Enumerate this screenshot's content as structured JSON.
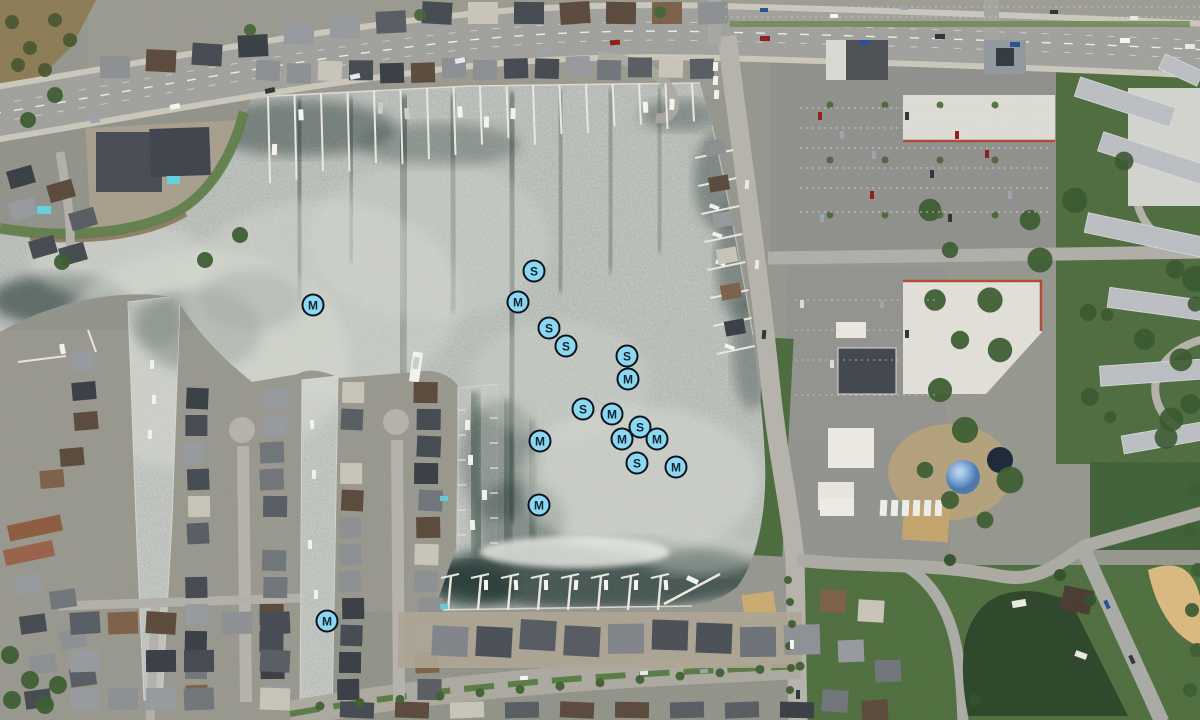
{
  "map": {
    "view": "satellite",
    "marker_style": {
      "fill": "#8ED7F0",
      "border": "#0C1420",
      "label_color": "#0C2433",
      "diameter_px": 23
    },
    "markers": [
      {
        "label": "M",
        "x": 313,
        "y": 305
      },
      {
        "label": "S",
        "x": 534,
        "y": 271
      },
      {
        "label": "M",
        "x": 518,
        "y": 302
      },
      {
        "label": "S",
        "x": 549,
        "y": 328
      },
      {
        "label": "S",
        "x": 566,
        "y": 346
      },
      {
        "label": "S",
        "x": 627,
        "y": 356
      },
      {
        "label": "M",
        "x": 628,
        "y": 379
      },
      {
        "label": "S",
        "x": 583,
        "y": 409
      },
      {
        "label": "M",
        "x": 612,
        "y": 414
      },
      {
        "label": "S",
        "x": 640,
        "y": 427
      },
      {
        "label": "M",
        "x": 622,
        "y": 439
      },
      {
        "label": "M",
        "x": 540,
        "y": 441
      },
      {
        "label": "M",
        "x": 657,
        "y": 439
      },
      {
        "label": "S",
        "x": 637,
        "y": 463
      },
      {
        "label": "M",
        "x": 676,
        "y": 467
      },
      {
        "label": "M",
        "x": 539,
        "y": 505
      },
      {
        "label": "M",
        "x": 327,
        "y": 621
      }
    ]
  }
}
